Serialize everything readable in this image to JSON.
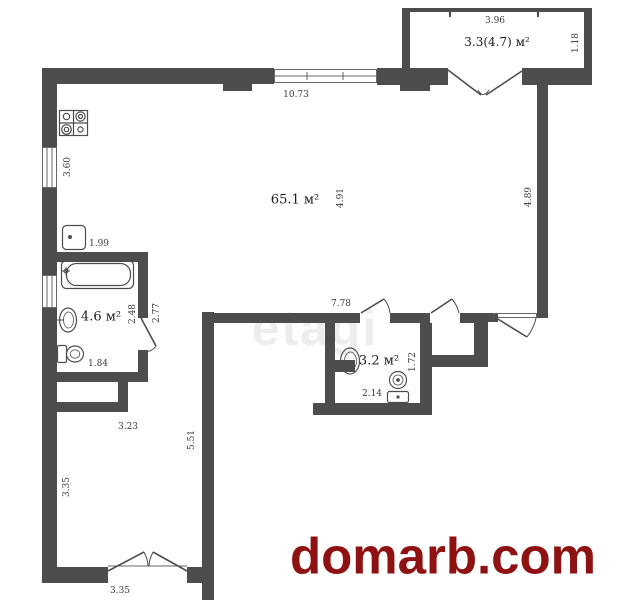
{
  "branding": {
    "watermark": "etagi",
    "site": "domarb.com"
  },
  "colors": {
    "wall": "#4d4d4d",
    "site_red": "#8e1212",
    "watermark_gray": "#ededed",
    "dim_text": "#3a3a3a",
    "background": "#ffffff"
  },
  "rooms": {
    "living": {
      "area": "65.1 м²"
    },
    "bathroom": {
      "area": "4.6 м²"
    },
    "wc": {
      "area": "3.2 м²"
    },
    "balcony": {
      "area": "3.3(4.7) м²"
    }
  },
  "dimensions": {
    "balcony_width": "3.96",
    "balcony_depth": "1.18",
    "top_window": "10.73",
    "kitchen_window": "3.60",
    "kitchen_sink": "1.99",
    "living_depth": "4.91",
    "right_wall": "4.89",
    "bath_width": "2.48",
    "bath_outer": "2.77",
    "corridor_top": "7.78",
    "bath_door": "1.84",
    "wc_height": "1.72",
    "wc_width": "2.14",
    "bedroom_top": "3.23",
    "corridor_height": "5.51",
    "bedroom_left": "3.35",
    "bedroom_bottom": "3.35"
  },
  "icons": [
    "stove-icon",
    "kitchen-sink-icon",
    "bathtub-icon",
    "bath-sink-icon",
    "bath-toilet-icon",
    "wc-sink-icon",
    "wc-toilet-icon"
  ]
}
